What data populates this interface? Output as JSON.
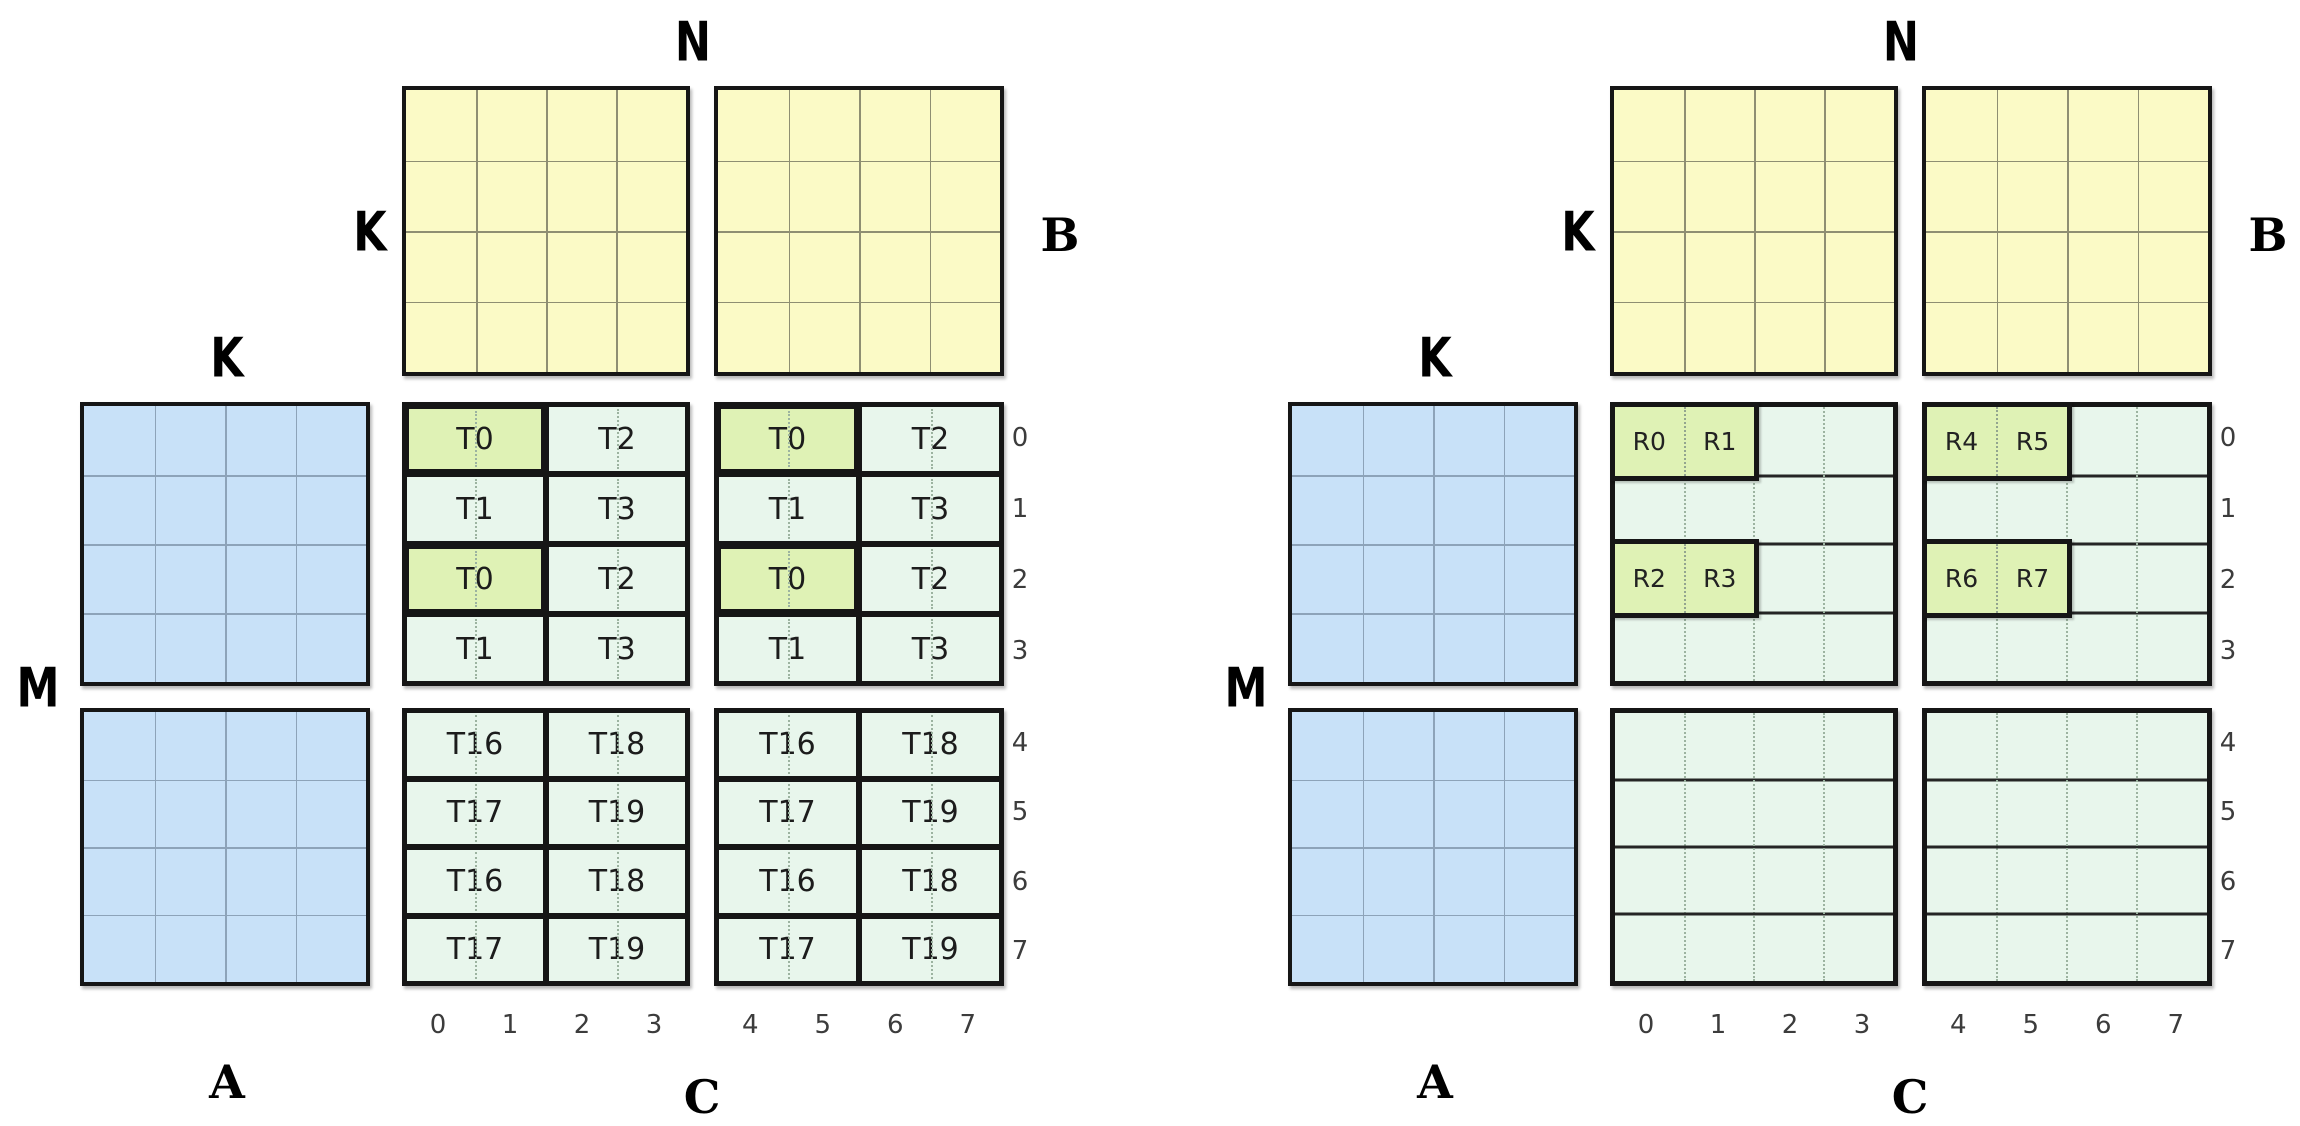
{
  "colors": {
    "matrix_a_fill": "#c8e1f8",
    "matrix_b_fill": "#fbfac6",
    "matrix_c_fill": "#e8f6ec",
    "highlight_fill": "#dff2b5",
    "border": "#161616",
    "index_text": "#3c3c3c"
  },
  "figures": [
    {
      "labels": {
        "n": "N",
        "k_b": "K",
        "b": "B",
        "k_a": "K",
        "m": "M",
        "a": "A",
        "c": "C"
      },
      "row_indices": [
        "0",
        "1",
        "2",
        "3",
        "4",
        "5",
        "6",
        "7"
      ],
      "col_indices": [
        "0",
        "1",
        "2",
        "3",
        "4",
        "5",
        "6",
        "7"
      ],
      "c_mode": "tiles",
      "c_top_cells": [
        [
          "T0",
          "T2"
        ],
        [
          "T1",
          "T3"
        ],
        [
          "T0",
          "T2"
        ],
        [
          "T1",
          "T3"
        ]
      ],
      "c_top_highlight": [
        [
          true,
          false
        ],
        [
          false,
          false
        ],
        [
          true,
          false
        ],
        [
          false,
          false
        ]
      ],
      "c_bottom_cells": [
        [
          "T16",
          "T18"
        ],
        [
          "T17",
          "T19"
        ],
        [
          "T16",
          "T18"
        ],
        [
          "T17",
          "T19"
        ]
      ]
    },
    {
      "labels": {
        "n": "N",
        "k_b": "K",
        "b": "B",
        "k_a": "K",
        "m": "M",
        "a": "A",
        "c": "C"
      },
      "row_indices": [
        "0",
        "1",
        "2",
        "3",
        "4",
        "5",
        "6",
        "7"
      ],
      "col_indices": [
        "0",
        "1",
        "2",
        "3",
        "4",
        "5",
        "6",
        "7"
      ],
      "c_mode": "strips",
      "r_boxes": [
        {
          "block": 0,
          "row": 0,
          "labels": [
            "R0",
            "R1"
          ]
        },
        {
          "block": 0,
          "row": 2,
          "labels": [
            "R2",
            "R3"
          ]
        },
        {
          "block": 1,
          "row": 0,
          "labels": [
            "R4",
            "R5"
          ]
        },
        {
          "block": 1,
          "row": 2,
          "labels": [
            "R6",
            "R7"
          ]
        }
      ]
    }
  ]
}
